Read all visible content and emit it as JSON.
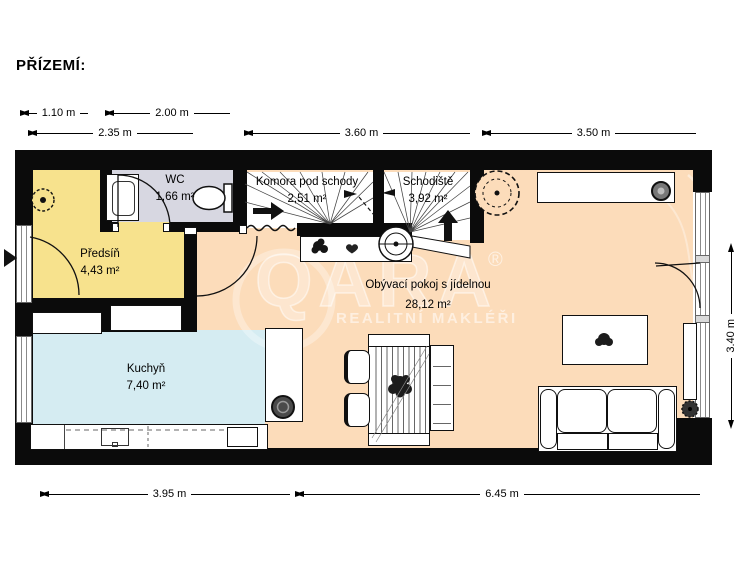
{
  "title": "PŘÍZEMÍ:",
  "watermark": {
    "brand": "QARA",
    "registered": "®",
    "tagline": "REALITNÍ MAKLÉŘI"
  },
  "rooms": {
    "predsin": {
      "name": "Předsíň",
      "area": "4,43 m²"
    },
    "wc": {
      "name": "WC",
      "area": "1,66 m²"
    },
    "komora": {
      "name": "Komora pod schody",
      "area": "2,51 m²"
    },
    "schodiste": {
      "name": "Schodiště",
      "area": "3,92 m²"
    },
    "kuchyn": {
      "name": "Kuchyň",
      "area": "7,40 m²"
    },
    "obyvak": {
      "name": "Obývací pokoj s jídelnou",
      "area": "28,12 m²"
    }
  },
  "dimensions": {
    "top": [
      {
        "label": "1.10 m"
      },
      {
        "label": "2.00 m"
      },
      {
        "label": "2.35 m"
      },
      {
        "label": "3.60 m"
      },
      {
        "label": "3.50 m"
      }
    ],
    "bottom": [
      {
        "label": "3.95 m"
      },
      {
        "label": "6.45 m"
      }
    ],
    "right": [
      {
        "label": "3.40 m"
      }
    ]
  },
  "colors": {
    "walls": "#0b0b0b",
    "room_predsin": "#f7e28d",
    "room_wc": "#d7d7e1",
    "room_living": "#fcdcba",
    "room_kitchen": "#d5ecf2",
    "room_stairs": "#ffffff",
    "watermark": "#ffffff"
  },
  "icons": {
    "entrance-arrow-icon": "▶",
    "stairs-up-arrow-icon": "⬆",
    "storage-arrow-icon": "➡",
    "plant-icon": "❀",
    "heart-icon": "♥"
  }
}
